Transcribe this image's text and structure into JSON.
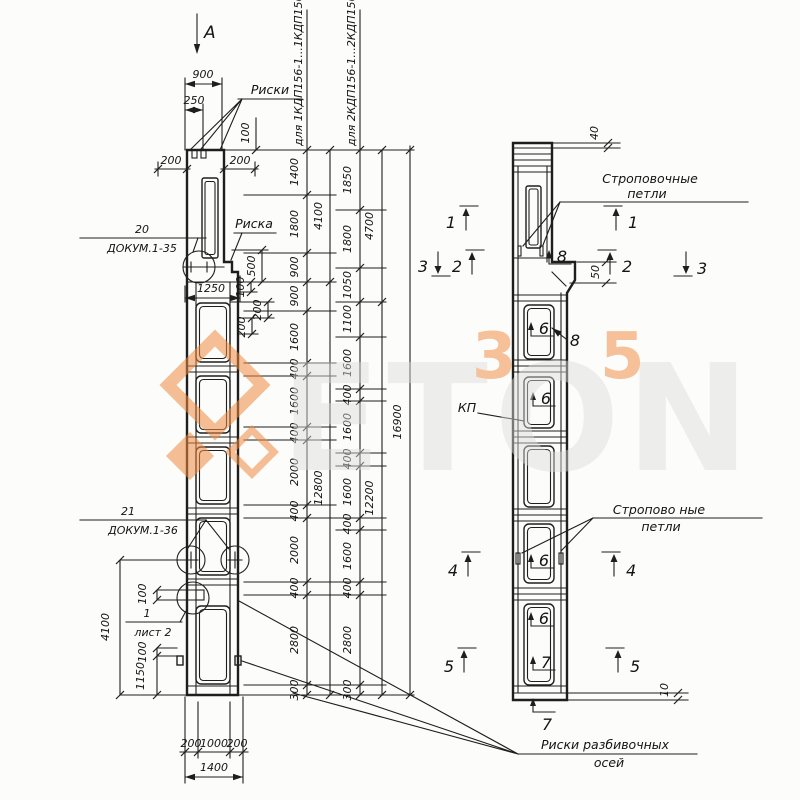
{
  "front": {
    "view_letter": "А",
    "riski": "Риски",
    "riska": "Риска",
    "c20": "20",
    "c20doc": "ДОКУМ.1-35",
    "c21": "21",
    "c21doc": "ДОКУМ.1-36",
    "c1": "1",
    "c1sheet": "лист 2",
    "axes1": "Риски разбивочных",
    "axes2": "осей",
    "d900": "900",
    "d250": "250",
    "d100top": "100",
    "d200l": "200",
    "d200r": "200",
    "d1250": "1250",
    "d500": "500",
    "d100c": "100",
    "d200s1": "200",
    "d200s2": "200",
    "d4100": "4100",
    "d100a": "100",
    "d100b": "100",
    "d1150": "1150",
    "b200l": "200",
    "b1000": "1000",
    "b200r": "200",
    "b1400": "1400"
  },
  "chains": {
    "a_label": "для 1КДП156-1...1КДП156-4",
    "b_label": "для 2КДП156-1...2КДП156-7",
    "a": [
      "1400",
      "1800",
      "900",
      "900",
      "1600",
      "400",
      "1600",
      "400",
      "2000",
      "400",
      "2000",
      "400",
      "2800",
      "300"
    ],
    "a_sub": [
      "4100",
      "12800"
    ],
    "b": [
      "1850",
      "1800",
      "1050",
      "1100",
      "1600",
      "400",
      "1600",
      "400",
      "1600",
      "400",
      "1600",
      "400",
      "2800",
      "300"
    ],
    "b_sub": [
      "4700",
      "12200"
    ],
    "total": "16900"
  },
  "side": {
    "loops_top1": "Строповочные",
    "loops_top2": "петли",
    "loops_bot1": "Стропово ные",
    "loops_bot2": "петли",
    "kp": "КП",
    "d40": "40",
    "d50": "50",
    "d10": "10",
    "s1": "1",
    "s2": "2",
    "s3": "3",
    "s4": "4",
    "s5": "5",
    "p6": "6",
    "p7": "7",
    "p8": "8"
  },
  "watermark": {
    "letters": "ETON",
    "d3": "3",
    "d5": "5",
    "orange": "#ef8b3f",
    "gray": "#dcdcdc"
  }
}
